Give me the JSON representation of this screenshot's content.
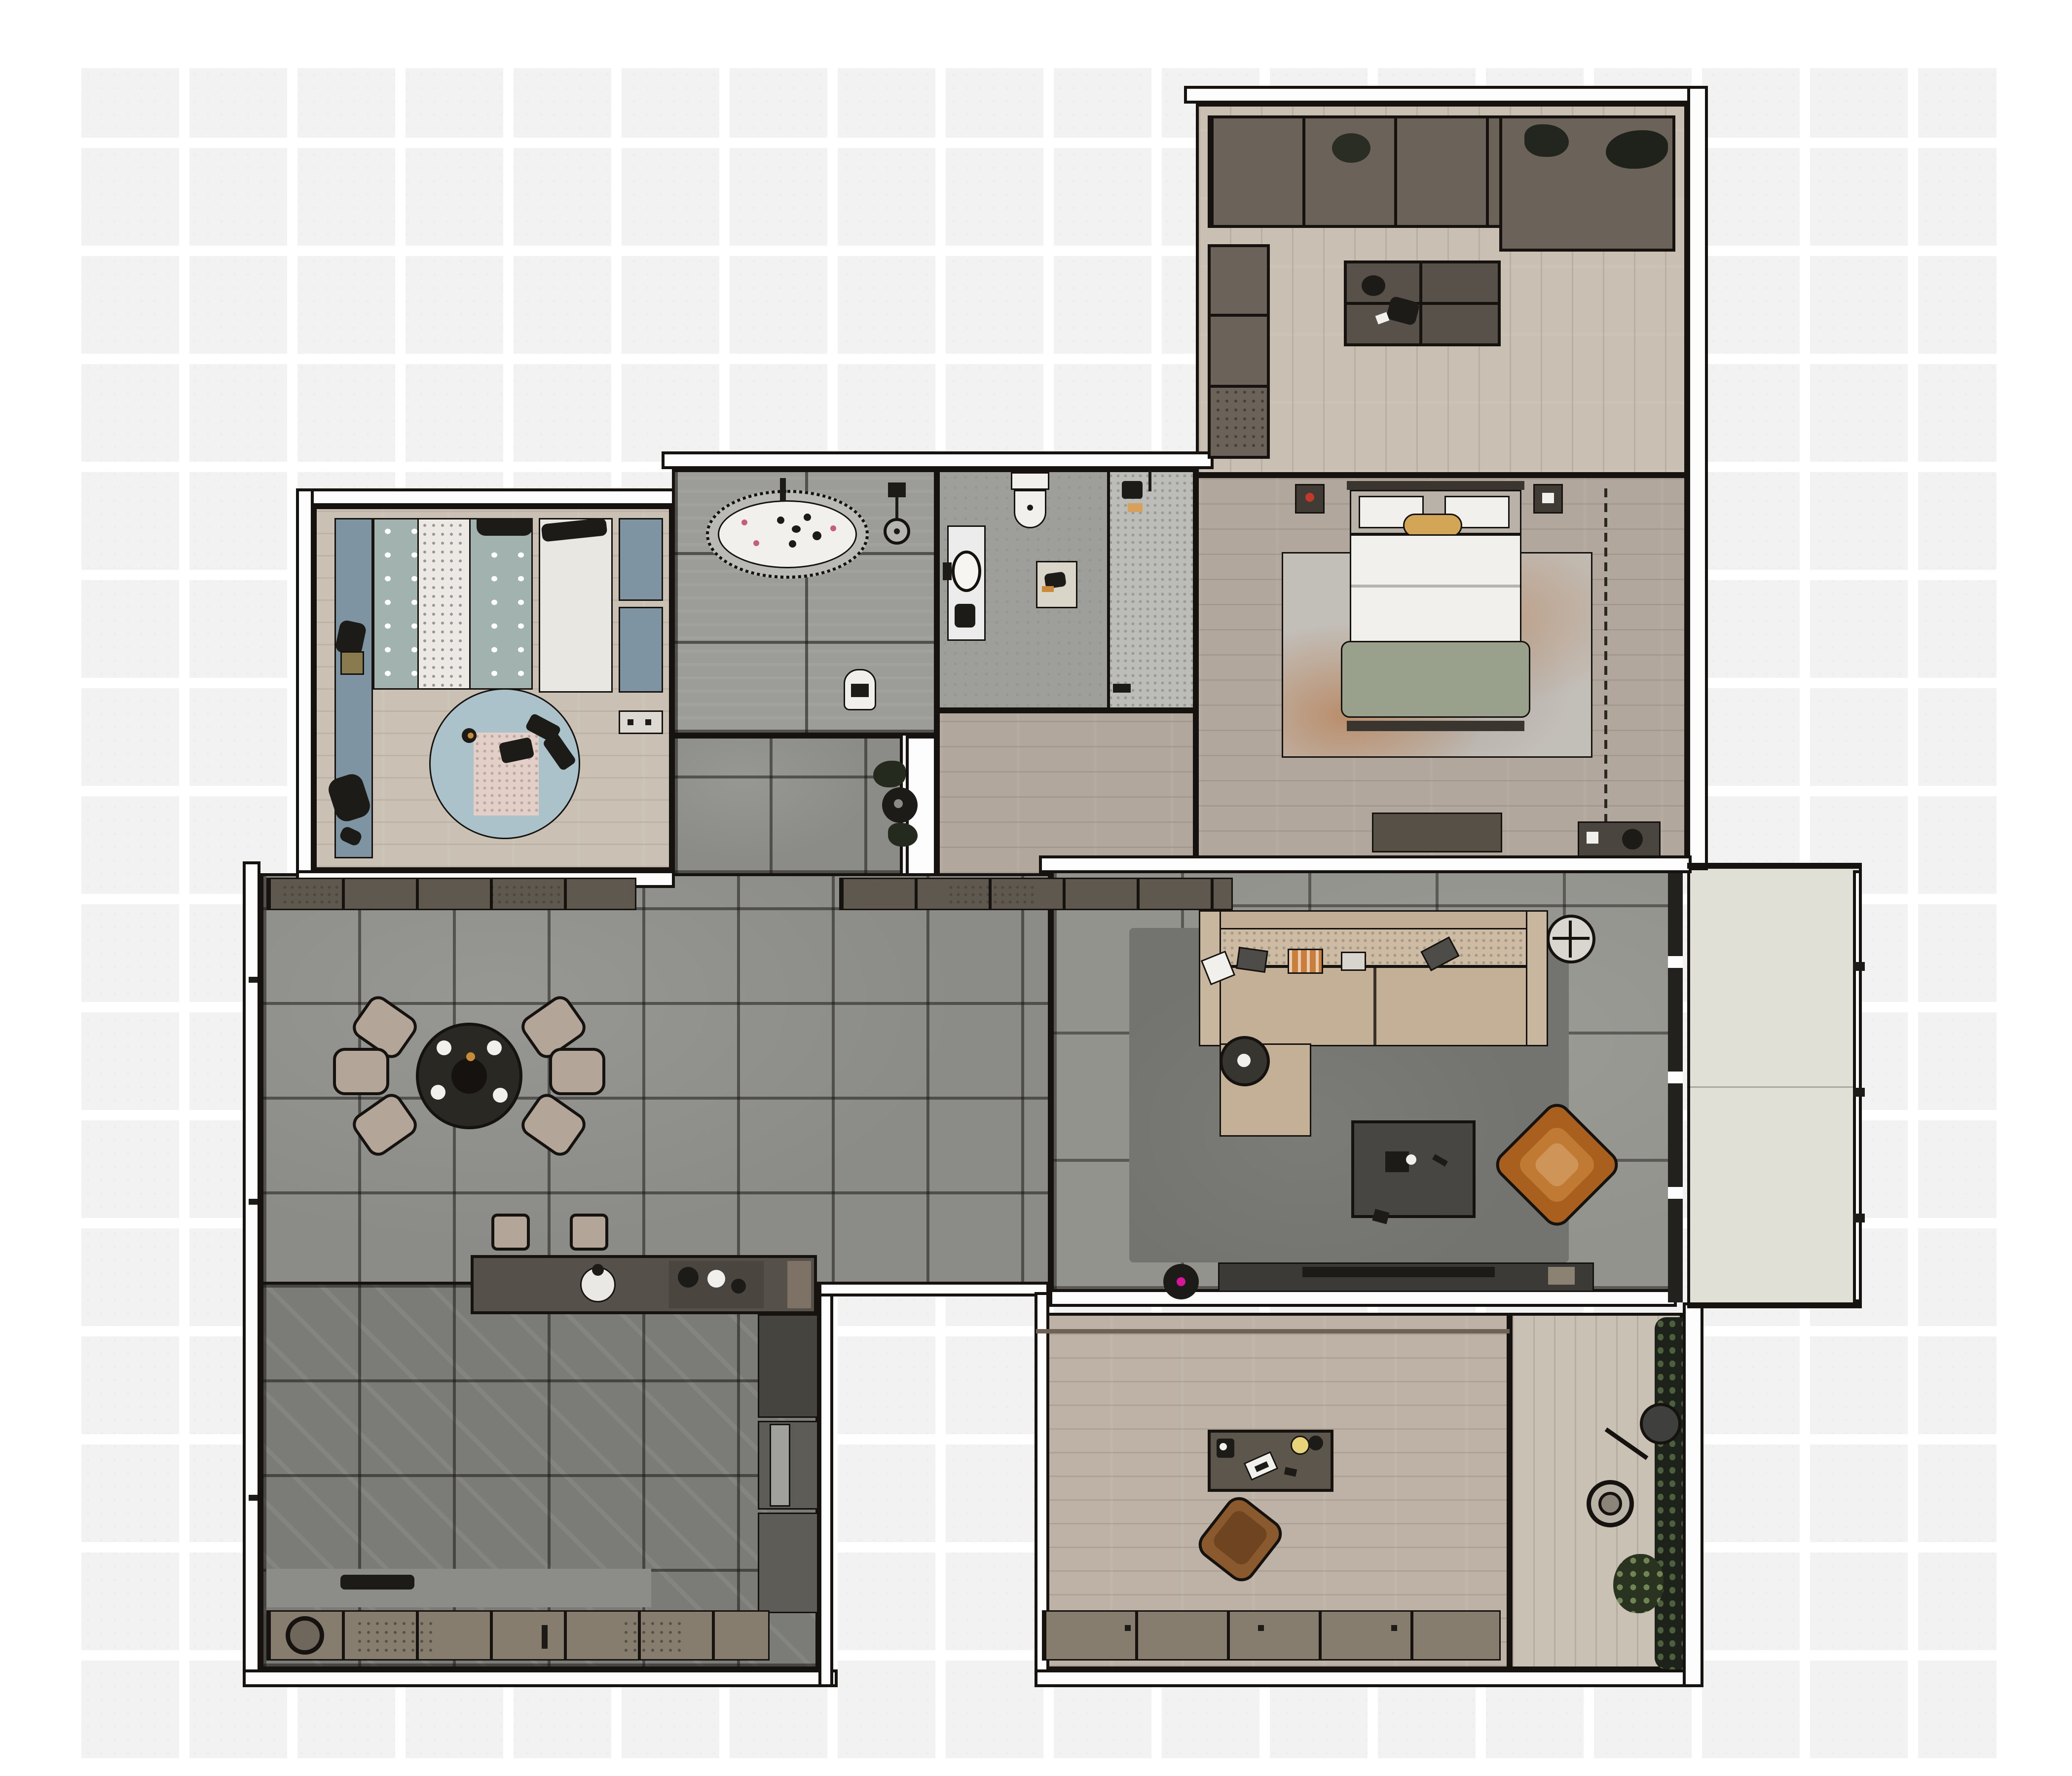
{
  "app": {
    "title": "Apartment floor plan – furnished top-down render",
    "background_color": "#ffffff",
    "exterior_grid_color": "#f2f2f3",
    "wall_fill": "#fdfdfd",
    "wall_line": "#15120f"
  },
  "palette": {
    "wood_light": "#c9bfb2",
    "wood_taupe": "#b2a79c",
    "wood_kid": "#cac0b4",
    "wood_office": "#bdb2a5",
    "wood_terrace": "#c8c1b4",
    "tile_bath": "#9c9c98",
    "tile_dining": "#8b8b87",
    "tile_living": "#93938d",
    "tile_kitchen": "#7b7b77",
    "concrete": "#9e9e9a",
    "balcony": "#e0e0d7",
    "cabinet": "#6b6359",
    "sofa_beige": "#c3b096",
    "rug_living": "#73736f",
    "rug_bed_accent": "#b3672e",
    "kid_teal": "#a2b2ae",
    "kid_blue": "#7e94a2",
    "kid_rug": "#abc2ca",
    "armchair_orange": "#a9601f",
    "sage_blanket": "#99a18d",
    "vacuum_led": "#d6169a"
  },
  "rooms": [
    {
      "id": "study",
      "floor": "#c9bfb2",
      "furniture": [
        "wardrobe-row",
        "corner-cabinet",
        "side-cabinet-column",
        "desk-cluster",
        "desk-chairs"
      ]
    },
    {
      "id": "master-bedroom",
      "floor": "#b2a79c",
      "furniture": [
        "area-rug",
        "double-bed",
        "nightstand-left",
        "nightstand-right",
        "dresser",
        "corner-unit",
        "wardrobe-dashed-zone"
      ]
    },
    {
      "id": "kids-bedroom",
      "floor": "#cac0b4",
      "furniture": [
        "play-mat-strip",
        "desk-chair",
        "kids-bed",
        "wardrobe-white",
        "cabinet-blue",
        "round-rug",
        "toys"
      ]
    },
    {
      "id": "bathroom",
      "floor": "#9c9c98",
      "furniture": [
        "bathtub",
        "shower-fixture",
        "floor-drain",
        "laundry-basket"
      ]
    },
    {
      "id": "shower-room",
      "floor": "#9e9e9a",
      "furniture": [
        "vanity-sink",
        "toilet",
        "bath-mat",
        "walk-in-shower"
      ]
    },
    {
      "id": "hallway-tiled",
      "floor": "#8b8b87",
      "furniture": [
        "potted-plant"
      ]
    },
    {
      "id": "hallway-wood",
      "floor": "#b2a79c",
      "furniture": []
    },
    {
      "id": "dining-area",
      "floor": "#8b8b87",
      "furniture": [
        "sideboard-left",
        "sideboard-right",
        "round-dining-table",
        "dining-chairs-x6",
        "bar-stools-x2",
        "kitchen-island",
        "island-sink",
        "island-hob"
      ]
    },
    {
      "id": "living-area",
      "floor": "#93938d",
      "furniture": [
        "area-rug",
        "l-shaped-sofa",
        "throw-pillows",
        "round-side-table",
        "coffee-table",
        "black-side-table",
        "orange-armchair",
        "tv-console",
        "tv",
        "robot-vacuum"
      ]
    },
    {
      "id": "kitchen",
      "floor": "#7b7b77",
      "furniture": [
        "tall-unit-column",
        "counter-strip",
        "base-cabinet-row",
        "cooktop-circle"
      ]
    },
    {
      "id": "office",
      "floor": "#bdb2a5",
      "furniture": [
        "desk",
        "desk-lamp",
        "speaker",
        "laptop",
        "leather-chair",
        "cabinet-row"
      ]
    },
    {
      "id": "balcony",
      "floor": "#e0e0d7",
      "furniture": [
        "railing"
      ]
    },
    {
      "id": "terrace",
      "floor": "#c8c1b4",
      "furniture": [
        "floor-lamp",
        "plant-pot",
        "hedge-plants"
      ]
    }
  ]
}
